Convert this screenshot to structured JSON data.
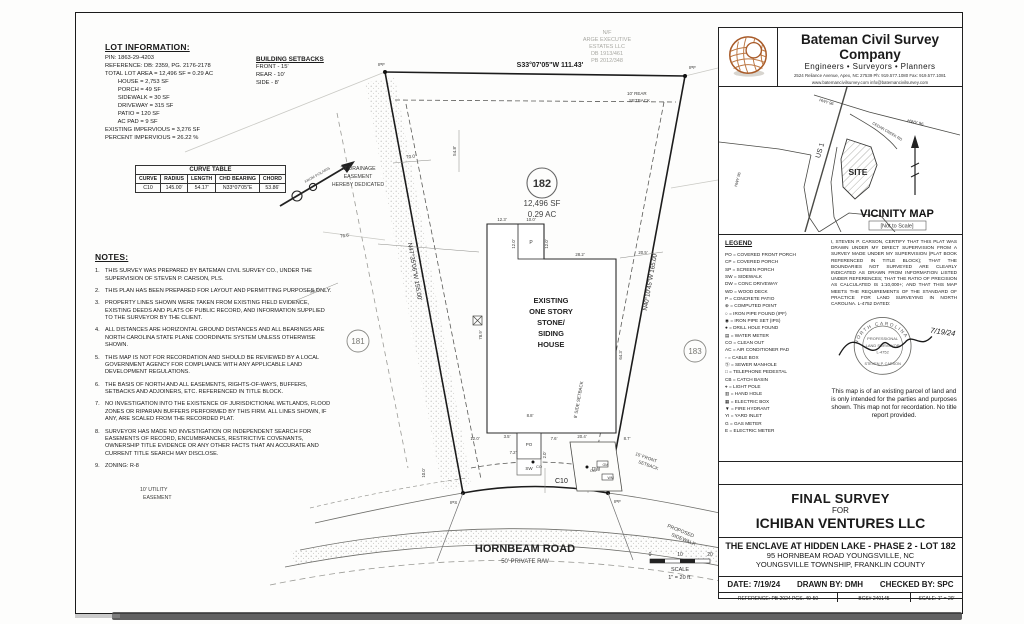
{
  "lot_information": {
    "title": "LOT INFORMATION:",
    "body": "PIN: 1863-29-4203\nREFERENCE: DB: 2359, PG. 2176-2178\nTOTAL LOT AREA = 12,496 SF = 0.29 AC\n        HOUSE = 2,753 SF\n        PORCH = 49 SF\n        SIDEWALK = 30 SF\n        DRIVEWAY = 315 SF\n        PATIO = 120 SF\n        AC PAD = 9 SF\nEXISTING IMPERVIOUS = 3,276 SF\nPERCENT IMPERVIOUS = 26.22 %"
  },
  "building_setbacks": {
    "title": "BUILDING SETBACKS",
    "body": "FRONT - 15'\nREAR - 10'\nSIDE - 8'"
  },
  "curve_table": {
    "title": "CURVE TABLE",
    "headers": [
      "CURVE",
      "RADIUS",
      "LENGTH",
      "CHD BEARING",
      "CHORD"
    ],
    "row": [
      "C10",
      "145.00'",
      "54.17'",
      "N33°07'05\"E",
      "53.86'"
    ]
  },
  "notes": {
    "title": "NOTES:",
    "items": [
      {
        "n": "1.",
        "t": "THIS SURVEY WAS PREPARED BY BATEMAN CIVIL SURVEY CO., UNDER THE SUPERVISION OF STEVEN P. CARSON, PLS."
      },
      {
        "n": "2.",
        "t": "THIS PLAN HAS BEEN PREPARED FOR LAYOUT AND PERMITTING PURPOSES ONLY."
      },
      {
        "n": "3.",
        "t": "PROPERTY LINES SHOWN WERE TAKEN FROM EXISTING FIELD EVIDENCE, EXISTING DEEDS AND PLATS OF PUBLIC RECORD, AND INFORMATION SUPPLIED TO THE SURVEYOR BY THE CLIENT."
      },
      {
        "n": "4.",
        "t": "ALL DISTANCES ARE HORIZONTAL GROUND DISTANCES AND ALL BEARINGS ARE NORTH CAROLINA  STATE PLANE COORDINATE SYSTEM UNLESS OTHERWISE SHOWN."
      },
      {
        "n": "5.",
        "t": "THIS MAP IS NOT FOR RECORDATION AND SHOULD BE REVIEWED BY A LOCAL GOVERNMENT AGENCY FOR COMPLIANCE WITH ANY APPLICABLE LAND DEVELOPMENT REGULATIONS."
      },
      {
        "n": "6.",
        "t": "THE BASIS OF NORTH AND ALL EASEMENTS, RIGHTS-OF-WAYS, BUFFERS, SETBACKS AND ADJOINERS, ETC. REFERENCED IN TITLE BLOCK."
      },
      {
        "n": "7.",
        "t": "NO INVESTIGATION INTO THE EXISTENCE OF JURISDICTIONAL WETLANDS, FLOOD ZONES OR RIPARIAN BUFFERS PERFORMED BY THIS FIRM. ALL LINES SHOWN, IF ANY, ARE SCALED FROM THE RECORDED PLAT."
      },
      {
        "n": "8.",
        "t": "SURVEYOR HAS MADE NO INVESTIGATION OR INDEPENDENT SEARCH FOR EASEMENTS OF RECORD, ENCUMBRANCES, RESTRICTIVE COVENANTS, OWNERSHIP TITLE EVIDENCE OR ANY OTHER FACTS THAT AN ACCURATE AND CURRENT TITLE SEARCH MAY DISCLOSE."
      },
      {
        "n": "9.",
        "t": "ZONING: R-8"
      }
    ]
  },
  "company": {
    "name": "Bateman Civil Survey Company",
    "tagline": "Engineers • Surveyors • Planners",
    "address": "2524 Reliance Avenue, Apex, NC 27539   Ph: 919.577.1080   Fax: 919.577.1081",
    "web": "www.batemancivilsurvey.com      info@batemancivilsurvey.com",
    "firm": "NCBELS Firm No. C-2378"
  },
  "vicinity": {
    "title": "VICINITY MAP",
    "nts": "[Not to Scale]",
    "site": "SITE",
    "us1": "US 1",
    "hwy96a": "HWY 96",
    "hwy96b": "HWY 96",
    "hwy96c": "HWY 96",
    "cedar": "CEDAR CREEK RD"
  },
  "legend": {
    "title": "LEGEND",
    "items": [
      "PO = COVERED FRONT PORCH",
      "CP = COVERED PORCH",
      "SP = SCREEN PORCH",
      "SW = SIDEWALK",
      "DW = CONC DRIVEWAY",
      "WD = WOOD DECK",
      "P = CONCRETE PATIO",
      "⊕ = COMPUTED POINT",
      "○ = IRON PIPE FOUND (IPF)",
      "◉ = IRON PIPE SET (IPS)",
      "● = DRILL HOLE FOUND",
      "▤ = WATER METER",
      "CO = CLEAN OUT",
      "AC = AIR CONDITIONER PAD",
      "▫ = CABLE BOX",
      "Ⓢ = SEWER MANHOLE",
      "□ = TELEPHONE PEDESTAL",
      "CB = CATCH BASIN",
      "⌖ = LIGHT POLE",
      "▥ = HAND HOLE",
      "▦ = ELECTRIC BOX",
      "▼ = FIRE HYDRANT",
      "YI = YARD INLET",
      "G = GAS METER",
      "E = ELECTRIC METER"
    ]
  },
  "certification": {
    "text": "I, STEVEN P. CARSON, CERTIFY THAT THIS PLAT WAS DRAWN UNDER MY DIRECT SUPERVISION FROM A SURVEY MADE UNDER MY SUPERVISION (PLAT BOOK REFERENCED IN TITLE BLOCK); THAT THE BOUNDARIES NOT SURVEYED ARE CLEARLY INDICATED AS DRAWN FROM INFORMATION LISTED UNDER REFERENCES; THAT THE RATIO OF PRECISION AS CALCULATED IS 1:10,000+; AND THAT THIS MAP MEETS THE REQUIREMENTS OF THE STANDARD OF PRACTICE FOR LAND SURVEYING IN NORTH CAROLINA. L-4752 DATED:",
    "seal_top": "NORTH CAROLINA",
    "seal_l1": "PROFESSIONAL",
    "seal_l2": "LAND SURVEYOR",
    "seal_l3": "L-4752",
    "seal_name": "STEVEN P. CARSON",
    "sign_date": "7/19/24"
  },
  "disclaimer": "This map is of an existing parcel of land and is only intended for the parties and purposes shown. This map not for recordation. No title report provided.",
  "title_block": {
    "l1": "FINAL SURVEY",
    "l2": "FOR",
    "l3": "ICHIBAN VENTURES LLC",
    "project": "THE ENCLAVE AT HIDDEN LAKE - PHASE 2 - LOT 182",
    "address": "95 HORNBEAM ROAD  YOUNGSVILLE, NC",
    "township": "YOUNGSVILLE TOWNSHIP, FRANKLIN COUNTY",
    "date": "DATE: 7/19/24",
    "drawn": "DRAWN BY: DMH",
    "checked": "CHECKED BY: SPC",
    "reference": "REFERENCE: PB 2024 PGS. 49-50",
    "bcs": "BCS# 240145",
    "scale": "SCALE: 1\" = 20'"
  },
  "drawing": {
    "adjoiner": {
      "l1": "N/F",
      "l2": "ARGE EXECUTIVE",
      "l3": "ESTATES LLC",
      "l4": "DB 1913/461",
      "l5": "PB 2012/348"
    },
    "bearing_top": "S33°07'05\"W   111.43'",
    "bearing_left": "N47°35'06\"W   155.00'",
    "bearing_right": "N40°10'45\"W   165.00'",
    "lot_number": "182",
    "area_sf": "12,496 SF",
    "area_ac": "0.29 AC",
    "lot_left": "181",
    "lot_right": "183",
    "house": {
      "l1": "EXISTING",
      "l2": "ONE STORY",
      "l3": "STONE/",
      "l4": "SIDING",
      "l5": "HOUSE"
    },
    "rear_setback1": "10' REAR",
    "rear_setback2": "SETBACK",
    "side_setback": "8' SIDE SETBACK",
    "front_setback1": "15' FRONT",
    "front_setback2": "SETBACK",
    "drain1": "20' DRAINAGE",
    "drain2": "EASEMENT",
    "drain3": "HEREBY DEDICATED",
    "util1": "10' UTILITY",
    "util2": "EASEMENT",
    "psw1": "PROPOSED",
    "psw2": "SIDEWALK",
    "road_name": "HORNBEAM ROAD",
    "road_rw": "50' PRIVATE R/W",
    "curve_label": "C10",
    "north_label": "FROM POLARIS",
    "ipf": "IPF",
    "ips": "IPS",
    "dims": {
      "d70": "70.0'",
      "d548": "54.8'",
      "d766": "76.6'",
      "d200": "20.0'",
      "d123": "12.3'",
      "d100": "10.0'",
      "d120a": "12.0'",
      "d120b": "12.0'",
      "d282": "28.2'",
      "d205": "20.5'",
      "d789": "78.9'",
      "d643": "64.3'",
      "d204": "20.4'",
      "d87": "8.7'",
      "d88": "8.8'",
      "d76": "7.6'",
      "d20": "2.0'",
      "d120c": "12.0'",
      "d35": "3.5'",
      "d72": "7.2'",
      "d100b": "10.0'"
    },
    "feat": {
      "p": "P",
      "po": "PO",
      "sw": "SW",
      "dw": "DW",
      "co1": "CO",
      "co2": "CO",
      "gm": "GM",
      "wm": "WM"
    },
    "scalebar": {
      "t0": "0",
      "t10": "10",
      "t20": "20",
      "l1": "SCALE",
      "l2": "1\" = 20 ft."
    }
  }
}
